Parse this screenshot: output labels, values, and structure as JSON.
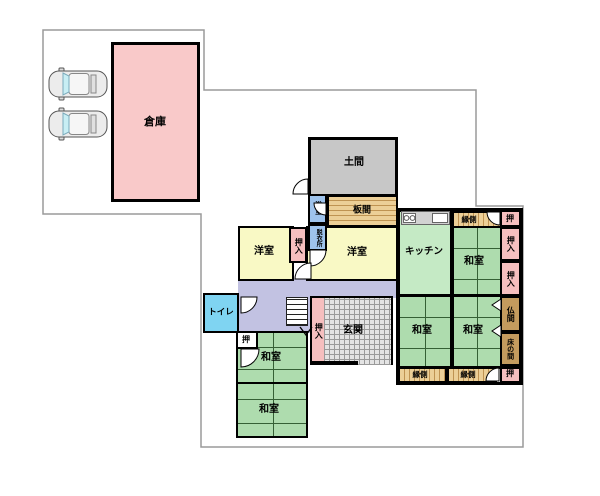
{
  "rooms": {
    "souko": "倉庫",
    "doma": "土間",
    "itanoma": "板間",
    "yokushitsu": "浴室",
    "datsuisho": "脱衣所",
    "youshitsu_left": "洋室",
    "youshitsu_right": "洋室",
    "oshiire_youshitsu": "押入",
    "kitchen": "キッチン",
    "engawa_top": "縁側",
    "oshi_top_right": "押",
    "oshiire_right_1": "押入",
    "oshiire_right_2": "押入",
    "washitsu_ne": "和室",
    "toilet": "トイレ",
    "oshiire_stairs": "押入",
    "genkan": "玄関",
    "washitsu_center": "和室",
    "washitsu_east": "和室",
    "butsuma": "仏間",
    "tokonoma": "床の間",
    "engawa_bottom_left": "縁側",
    "engawa_bottom_right": "縁側",
    "oshi_bottom_right": "押",
    "oshi_southwest": "押",
    "washitsu_sw_upper": "和室",
    "washitsu_sw_lower": "和室"
  },
  "parking": {
    "car_count": 2
  },
  "colors": {
    "storage": "#f9c9c9",
    "closet": "#f6bfbf",
    "western": "#f9f9c5",
    "tatami": "#aedcae",
    "kitchen": "#c5eac5",
    "toilet": "#7fd4f2",
    "hallway": "#c2c2e2",
    "doma": "#c7c7c7",
    "wood": "#eccf97",
    "wood_stripe": "#bf9352",
    "alcove": "#c49b5e",
    "bath": "#9ec3ec",
    "wall": "#000000",
    "boundary": "#9a9a9a"
  }
}
